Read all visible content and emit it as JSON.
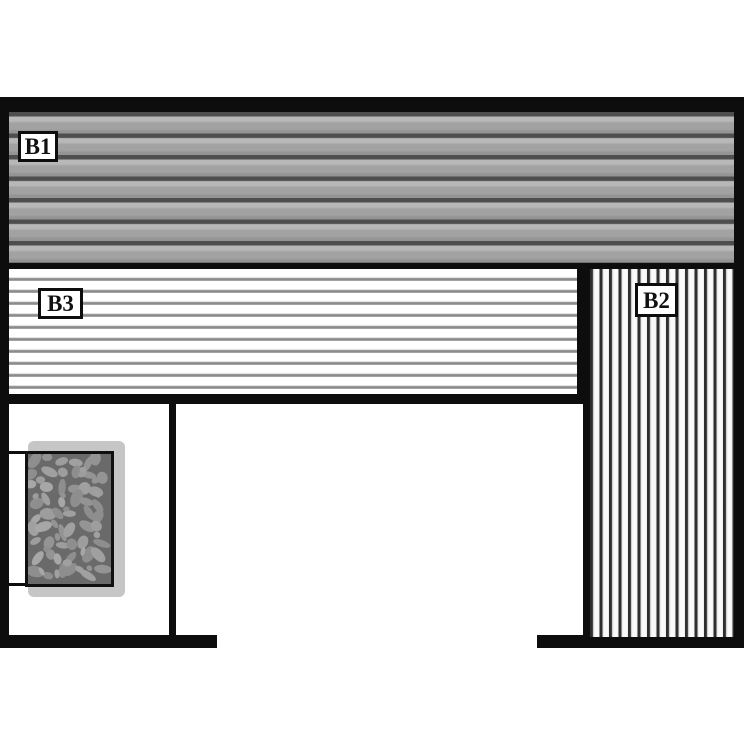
{
  "diagram": {
    "type": "sauna-bench-floor-plan",
    "benches": {
      "b1": {
        "label": "B1",
        "orientation": "horizontal-slats",
        "position": "top-full-width"
      },
      "b2": {
        "label": "B2",
        "orientation": "vertical-slats",
        "position": "right-column"
      },
      "b3": {
        "label": "B3",
        "orientation": "horizontal-slats",
        "position": "middle-left"
      }
    },
    "heater": {
      "name": "stone-heater",
      "position": "lower-left-room"
    }
  },
  "colors": {
    "wall": "#0d0d0d",
    "b1_base": "#a2a2a2",
    "b1_stripe": "#4e4e4e",
    "b3_line": "#8c8c8c",
    "b2_line": "#2e2e2e",
    "heater_plate": "#c6c6c6",
    "stones_bg": "#6a6a6a",
    "stone_fill": "#9d9d9d",
    "background": "#ffffff"
  }
}
